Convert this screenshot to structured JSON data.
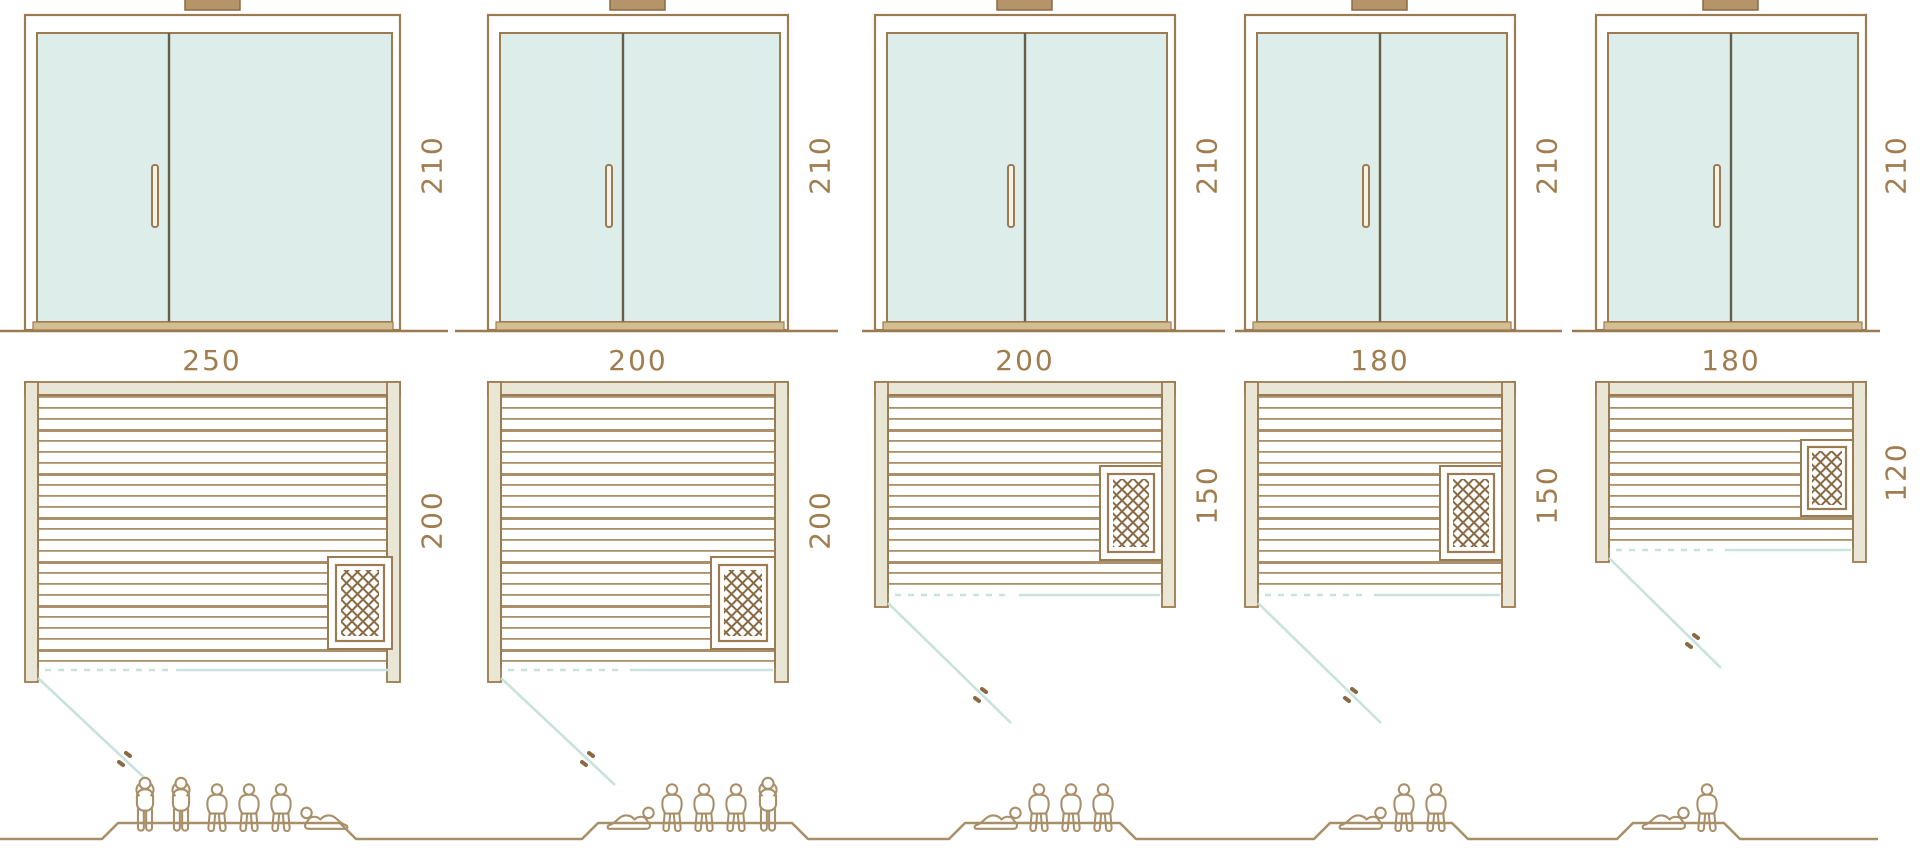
{
  "diagram_type": "sauna-size-comparison",
  "colors": {
    "outline": "#9b7b51",
    "outline_dark": "#8a6a42",
    "glass": "#dcedea",
    "wood_fill": "#e9e6d5",
    "threshold": "#d3bd93",
    "door_swing_teal": "#c7e3de",
    "dimension_text": "#a17c4e",
    "figure_outline": "#a98f68",
    "background": "#ffffff"
  },
  "icons": {
    "roof_vent": "roof-vent-icon",
    "door_handle_front": "door-handle-icon",
    "door_handle_plan": "plan-door-handle-icon",
    "heater": "heater-icon",
    "person_standing": "person-standing-icon",
    "person_sitting": "person-sitting-icon",
    "person_lying": "person-lying-icon"
  },
  "models": [
    {
      "name": "sauna-250x200",
      "front": {
        "height_label": "210"
      },
      "plan": {
        "width_label": "250",
        "depth_label": "200"
      },
      "capacity": {
        "total": 6,
        "standing": 2,
        "sitting": 3,
        "lying": 1
      }
    },
    {
      "name": "sauna-200x200",
      "front": {
        "height_label": "210"
      },
      "plan": {
        "width_label": "200",
        "depth_label": "200"
      },
      "capacity": {
        "total": 5,
        "standing": 1,
        "sitting": 3,
        "lying": 1
      }
    },
    {
      "name": "sauna-200x150",
      "front": {
        "height_label": "210"
      },
      "plan": {
        "width_label": "200",
        "depth_label": "150"
      },
      "capacity": {
        "total": 4,
        "standing": 0,
        "sitting": 3,
        "lying": 1
      }
    },
    {
      "name": "sauna-180x150",
      "front": {
        "height_label": "210"
      },
      "plan": {
        "width_label": "180",
        "depth_label": "150"
      },
      "capacity": {
        "total": 3,
        "standing": 0,
        "sitting": 2,
        "lying": 1
      }
    },
    {
      "name": "sauna-180x120",
      "front": {
        "height_label": "210"
      },
      "plan": {
        "width_label": "180",
        "depth_label": "120"
      },
      "capacity": {
        "total": 2,
        "standing": 0,
        "sitting": 1,
        "lying": 1
      }
    }
  ]
}
